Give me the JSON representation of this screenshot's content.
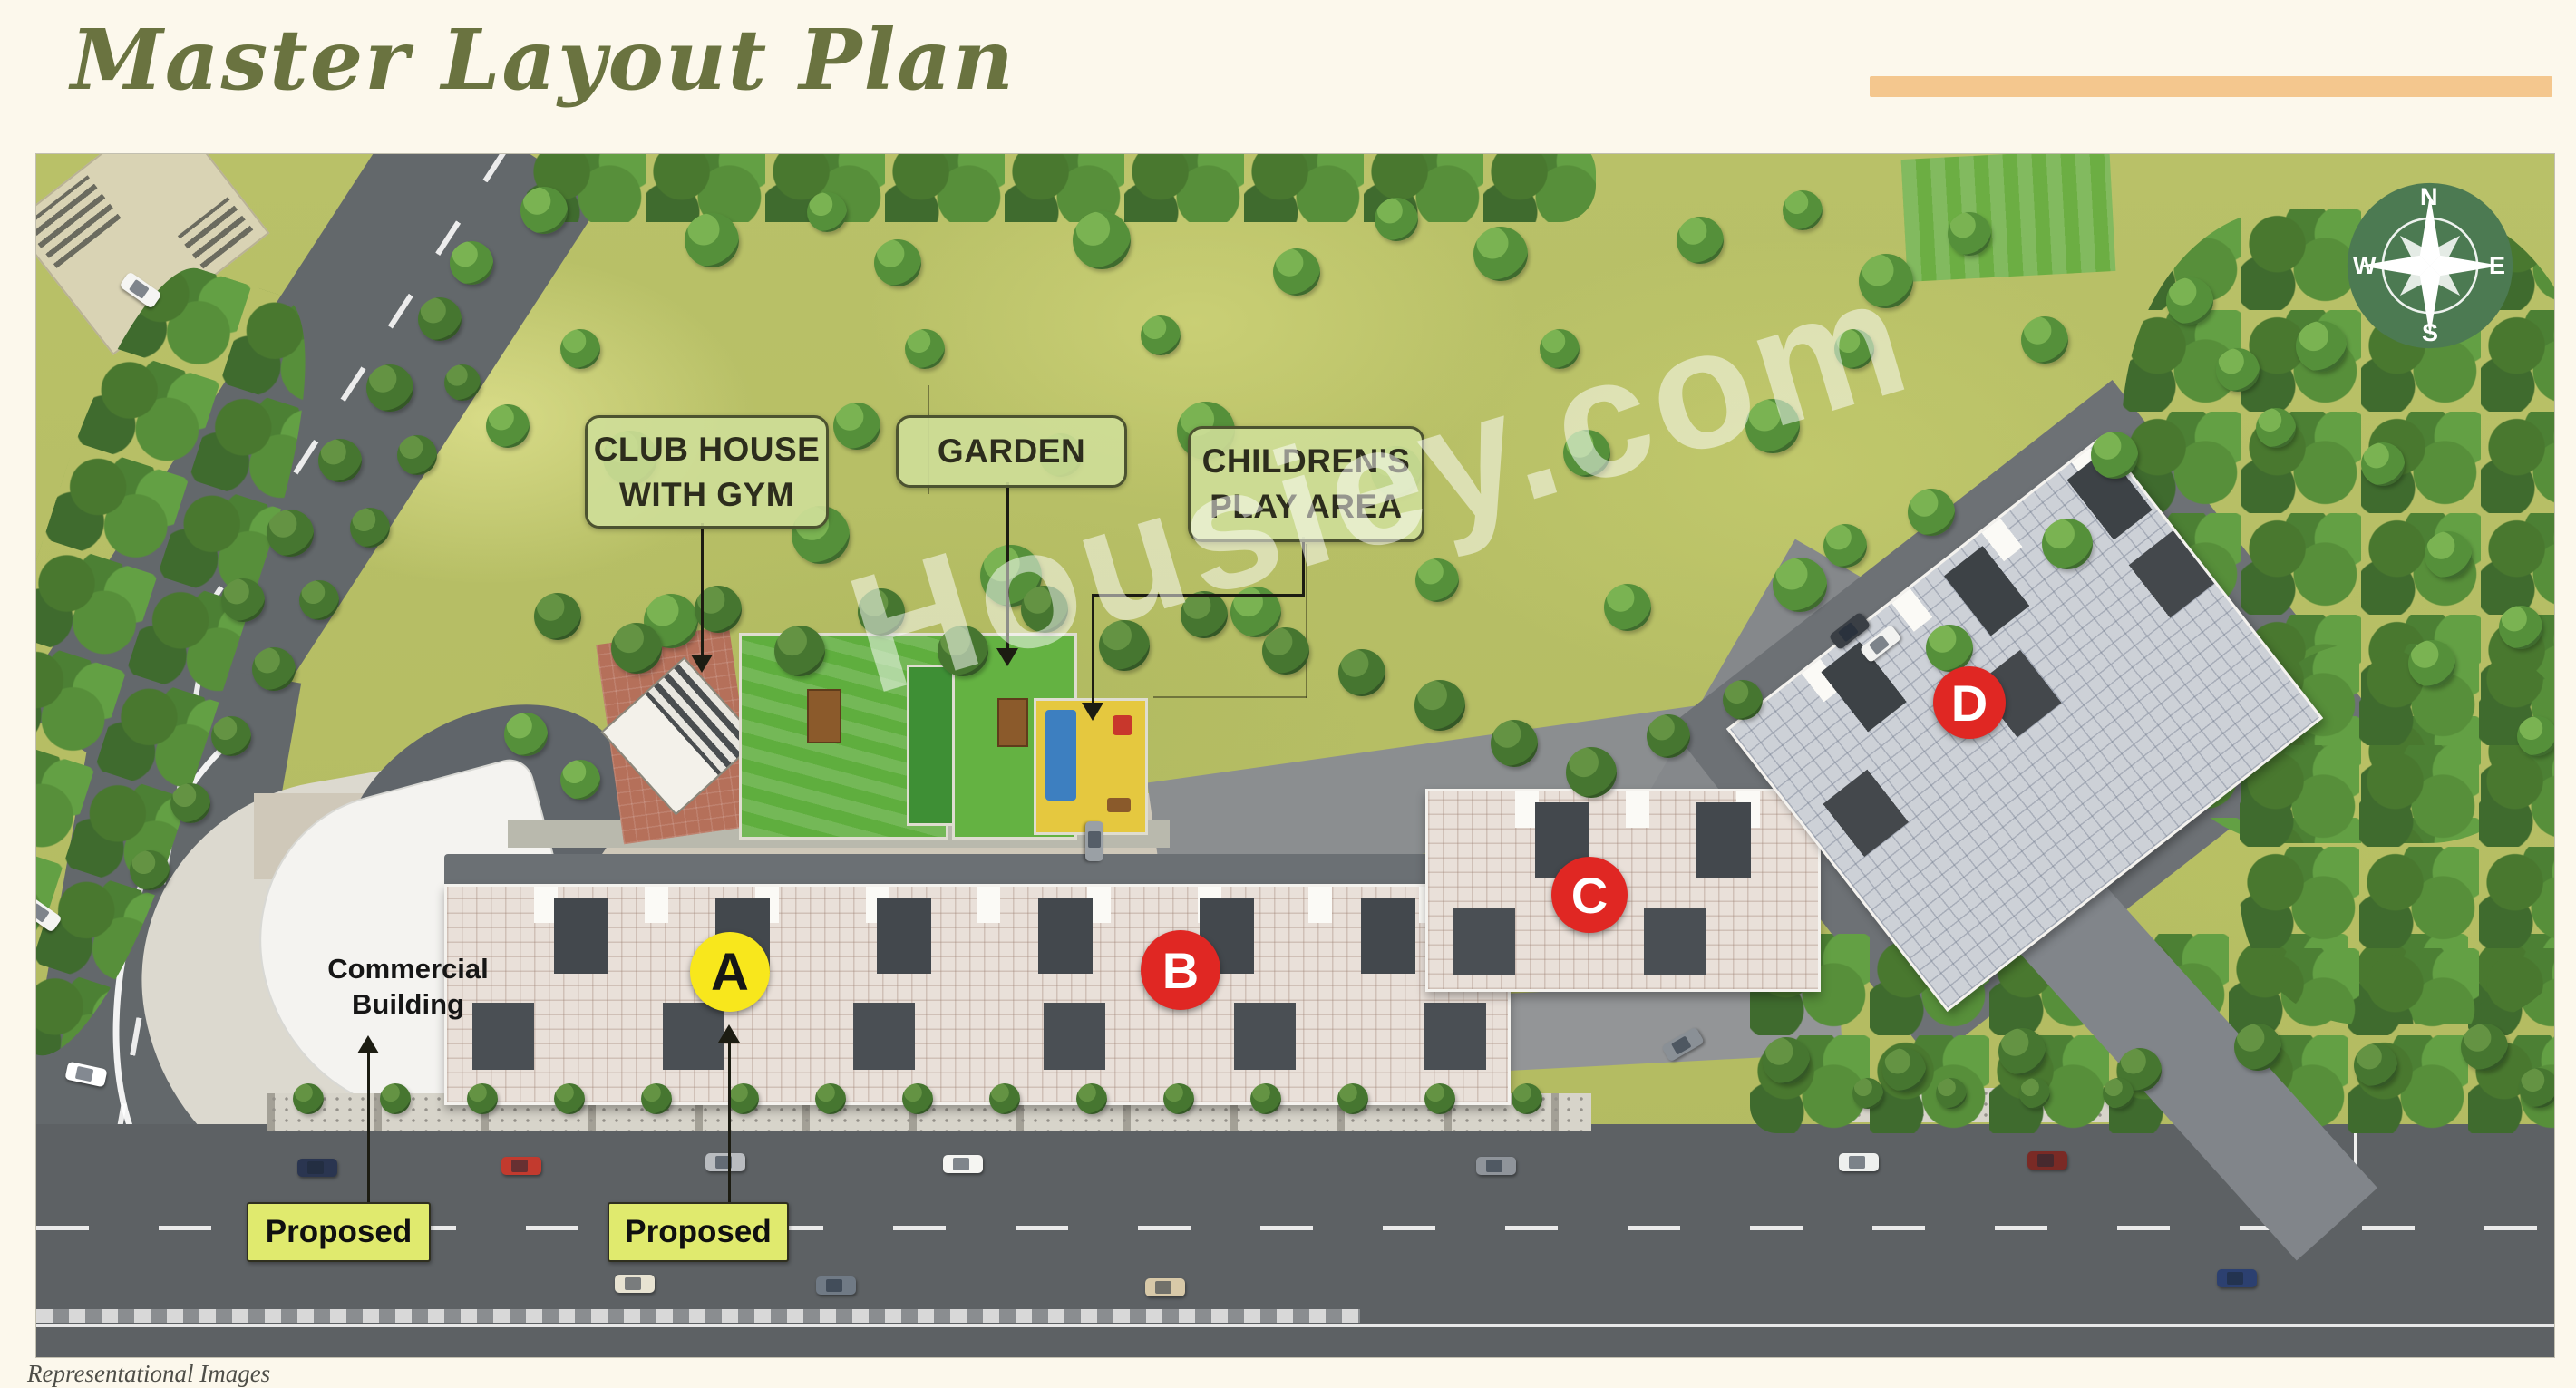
{
  "page": {
    "title": "Master Layout Plan",
    "watermark": "Housiey.com",
    "footer_note": "Representational Images"
  },
  "plan": {
    "amenity_labels": [
      {
        "id": "club-house",
        "line1": "CLUB HOUSE",
        "line2": "WITH GYM"
      },
      {
        "id": "garden",
        "line1": "GARDEN",
        "line2": ""
      },
      {
        "id": "children-play-area",
        "line1": "CHILDREN'S",
        "line2": "PLAY AREA"
      }
    ],
    "buildings": [
      {
        "letter": "A",
        "marker_color": "#f8e71c",
        "letter_color": "#161616"
      },
      {
        "letter": "B",
        "marker_color": "#e02723",
        "letter_color": "#ffffff"
      },
      {
        "letter": "C",
        "marker_color": "#e02723",
        "letter_color": "#ffffff"
      },
      {
        "letter": "D",
        "marker_color": "#e02723",
        "letter_color": "#ffffff"
      }
    ],
    "annotations": {
      "commercial_line1": "Commercial",
      "commercial_line2": "Building",
      "proposed_left": "Proposed",
      "proposed_right": "Proposed"
    },
    "compass": {
      "n": "N",
      "e": "E",
      "s": "S",
      "w": "W"
    },
    "colors": {
      "title_green": "#6a7340",
      "accent_bar": "#f4c78e",
      "label_box_fill": "#cede98",
      "proposed_box_fill": "#e0ea6e",
      "marker_red": "#e02723",
      "marker_yellow": "#f8e71c",
      "grass": "#b7bf65",
      "road": "#5d6164"
    }
  },
  "scene": {
    "trees": [
      [
        745,
        95,
        30,
        1
      ],
      [
        950,
        120,
        26,
        1
      ],
      [
        1175,
        95,
        32,
        1
      ],
      [
        1390,
        130,
        26,
        1
      ],
      [
        1615,
        110,
        30,
        1
      ],
      [
        1835,
        95,
        26,
        1
      ],
      [
        2040,
        140,
        30,
        1
      ],
      [
        560,
        62,
        26,
        1
      ],
      [
        872,
        64,
        22,
        1
      ],
      [
        1500,
        72,
        24,
        1
      ],
      [
        1948,
        62,
        22,
        1
      ],
      [
        2215,
        205,
        26,
        1
      ],
      [
        2132,
        88,
        24,
        1
      ],
      [
        655,
        335,
        30,
        1
      ],
      [
        865,
        420,
        32,
        1
      ],
      [
        1075,
        465,
        34,
        1
      ],
      [
        1290,
        305,
        32,
        1
      ],
      [
        1500,
        350,
        28,
        1
      ],
      [
        1710,
        330,
        26,
        1
      ],
      [
        1915,
        300,
        30,
        1
      ],
      [
        2090,
        395,
        26,
        1
      ],
      [
        700,
        515,
        30,
        1
      ],
      [
        905,
        300,
        26,
        1
      ],
      [
        1130,
        332,
        24,
        1
      ],
      [
        1345,
        505,
        28,
        1
      ],
      [
        1545,
        470,
        24,
        1
      ],
      [
        1755,
        500,
        26,
        1
      ],
      [
        1945,
        475,
        30,
        1
      ],
      [
        2110,
        545,
        26,
        1
      ],
      [
        2240,
        430,
        28,
        1
      ],
      [
        480,
        120,
        24,
        1
      ],
      [
        600,
        215,
        22,
        1
      ],
      [
        520,
        300,
        24,
        1
      ],
      [
        980,
        215,
        22,
        1
      ],
      [
        1240,
        200,
        22,
        1
      ],
      [
        1680,
        215,
        22,
        1
      ],
      [
        2005,
        215,
        22,
        1
      ],
      [
        575,
        510,
        26,
        0
      ],
      [
        662,
        545,
        28,
        0
      ],
      [
        752,
        502,
        26,
        0
      ],
      [
        842,
        548,
        28,
        0
      ],
      [
        932,
        505,
        26,
        0
      ],
      [
        1022,
        548,
        28,
        0
      ],
      [
        1112,
        502,
        26,
        0
      ],
      [
        1200,
        542,
        28,
        0
      ],
      [
        1288,
        508,
        26,
        0
      ],
      [
        1378,
        548,
        26,
        0
      ],
      [
        1462,
        572,
        26,
        0
      ],
      [
        1548,
        608,
        28,
        0
      ],
      [
        1630,
        650,
        26,
        0
      ],
      [
        1715,
        682,
        28,
        0
      ],
      [
        1800,
        642,
        24,
        0
      ],
      [
        1882,
        602,
        22,
        0
      ],
      [
        445,
        182,
        24,
        0
      ],
      [
        390,
        258,
        26,
        0
      ],
      [
        335,
        338,
        24,
        0
      ],
      [
        280,
        418,
        26,
        0
      ],
      [
        228,
        492,
        24,
        0
      ],
      [
        470,
        252,
        20,
        0
      ],
      [
        420,
        332,
        22,
        0
      ],
      [
        368,
        412,
        22,
        0
      ],
      [
        312,
        492,
        22,
        0
      ],
      [
        262,
        568,
        24,
        0
      ],
      [
        215,
        642,
        22,
        0
      ],
      [
        170,
        716,
        22,
        0
      ],
      [
        125,
        790,
        22,
        0
      ],
      [
        540,
        640,
        24,
        1
      ],
      [
        600,
        690,
        22,
        1
      ],
      [
        2375,
        162,
        26,
        1
      ],
      [
        2520,
        212,
        28,
        1
      ],
      [
        2660,
        442,
        26,
        1
      ],
      [
        2588,
        342,
        24,
        1
      ],
      [
        2470,
        302,
        22,
        1
      ],
      [
        2740,
        522,
        24,
        1
      ],
      [
        2642,
        562,
        26,
        1
      ],
      [
        2758,
        642,
        22,
        1
      ],
      [
        1995,
        432,
        24,
        1
      ],
      [
        2292,
        332,
        26,
        1
      ],
      [
        2428,
        238,
        24,
        1
      ],
      [
        1930,
        1000,
        26,
        0
      ],
      [
        2060,
        1010,
        24,
        0
      ],
      [
        2190,
        990,
        26,
        0
      ],
      [
        2320,
        1010,
        24,
        0
      ],
      [
        2450,
        985,
        26,
        0
      ],
      [
        2580,
        1005,
        24,
        0
      ],
      [
        2700,
        985,
        26,
        0
      ],
      [
        2760,
        1030,
        22,
        0
      ],
      [
        300,
        1042,
        17,
        0
      ],
      [
        396,
        1042,
        17,
        0
      ],
      [
        492,
        1042,
        17,
        0
      ],
      [
        588,
        1042,
        17,
        0
      ],
      [
        684,
        1042,
        17,
        0
      ],
      [
        780,
        1042,
        17,
        0
      ],
      [
        876,
        1042,
        17,
        0
      ],
      [
        972,
        1042,
        17,
        0
      ],
      [
        1068,
        1042,
        17,
        0
      ],
      [
        1164,
        1042,
        17,
        0
      ],
      [
        1260,
        1042,
        17,
        0
      ],
      [
        1356,
        1042,
        17,
        0
      ],
      [
        1452,
        1042,
        17,
        0
      ],
      [
        1548,
        1042,
        17,
        0
      ],
      [
        1644,
        1042,
        17,
        0
      ],
      [
        2020,
        1036,
        17,
        0
      ],
      [
        2112,
        1036,
        17,
        0
      ],
      [
        2204,
        1036,
        17,
        0
      ],
      [
        2296,
        1036,
        17,
        0
      ]
    ],
    "cars": [
      [
        310,
        1118,
        0,
        "#2a3550"
      ],
      [
        535,
        1116,
        0,
        "#c23a2e"
      ],
      [
        760,
        1112,
        0,
        "#b9bcc0"
      ],
      [
        1022,
        1114,
        0,
        "#f5f5f2"
      ],
      [
        1610,
        1116,
        0,
        "#8f949a"
      ],
      [
        2010,
        1112,
        0,
        "#eef0ee"
      ],
      [
        2218,
        1110,
        0,
        "#7a2a25"
      ],
      [
        660,
        1246,
        0,
        "#e8e3d2"
      ],
      [
        882,
        1248,
        0,
        "#707a85"
      ],
      [
        1245,
        1250,
        0,
        "#d8c9a8"
      ],
      [
        2427,
        1240,
        0,
        "#2c4070"
      ],
      [
        5,
        838,
        35,
        "#f4f4f2"
      ],
      [
        55,
        1015,
        12,
        "#ffffff"
      ],
      [
        115,
        150,
        35,
        "#f5f5f3"
      ],
      [
        1167,
        758,
        90,
        "#9aa0a5"
      ],
      [
        2000,
        526,
        -38,
        "#3a3f45"
      ],
      [
        2034,
        540,
        -38,
        "#f2f2f0"
      ],
      [
        1816,
        982,
        -30,
        "#8a9096"
      ]
    ]
  }
}
